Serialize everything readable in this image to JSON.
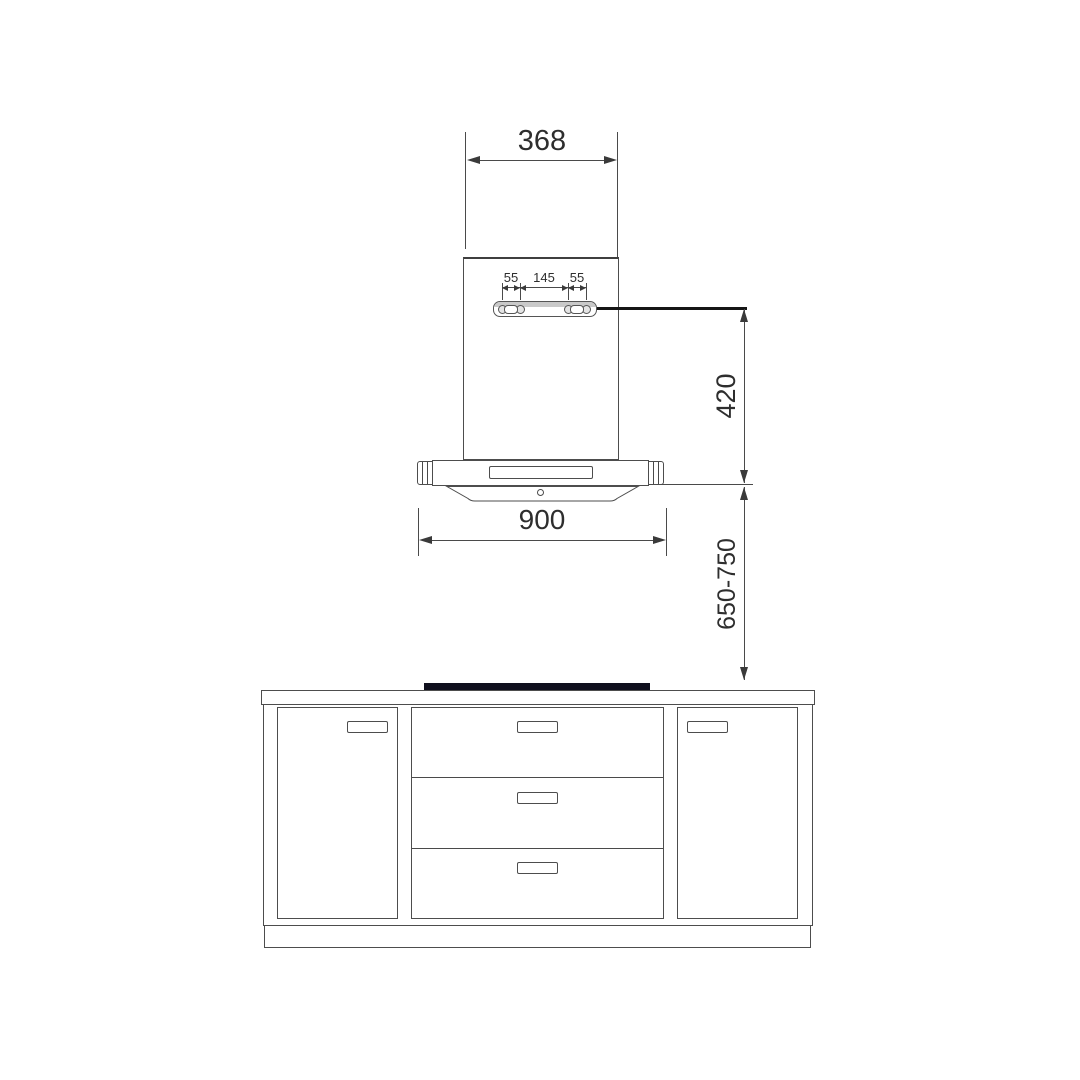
{
  "diagram": {
    "type": "technical-installation-drawing",
    "subject": "kitchen island range hood above base cabinet with cooktop",
    "units": "mm"
  },
  "dims": {
    "chimney_width": "368",
    "bracket_left": "55",
    "bracket_center": "145",
    "bracket_right": "55",
    "hood_height": "420",
    "hood_width": "900",
    "install_height": "650-750"
  },
  "colors": {
    "background": "#ffffff",
    "line": "#4d4d4d",
    "text": "#2e2e2e",
    "leader_line": "#161616",
    "bracket_band": "#c9c9c9",
    "cooktop": "#10101e"
  },
  "components": [
    "chimney-duct",
    "hood-body",
    "mounting-bracket",
    "hood-canopy",
    "canopy-vent-panel",
    "canopy-bottom-panel",
    "cooktop",
    "countertop",
    "cabinet-body",
    "cabinet-door-left",
    "drawer-stack",
    "cabinet-door-right",
    "plinth"
  ]
}
